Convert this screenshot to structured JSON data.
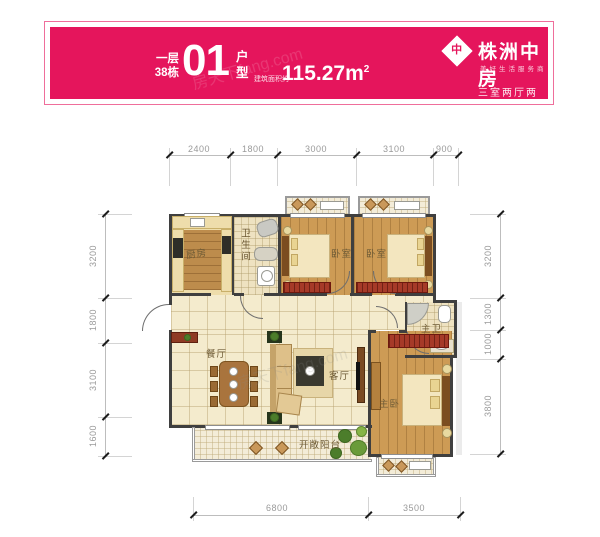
{
  "header": {
    "floor": "一层",
    "building": "38栋",
    "unit": "01",
    "unit_top": "户",
    "unit_bottom": "型",
    "area_prefix": "建筑面积约",
    "area_value": "115.27m",
    "area_exp": "2",
    "logo_glyph": "中",
    "brand": "株洲中房",
    "tagline": "美好生活服务商",
    "summary": "三室两厅两卫",
    "banner_color": "#e5155c"
  },
  "watermark": "房天下fang.com",
  "rooms": {
    "kitchen": "厨房",
    "bathroom": "卫生间",
    "bedroom1": "卧室",
    "bedroom2": "卧室",
    "master_bath": "主卫",
    "master_bedroom": "主卧",
    "dining": "餐厅",
    "living": "客厅",
    "balcony": "开敞阳台"
  },
  "dims": {
    "top": [
      "2400",
      "1800",
      "3000",
      "3100",
      "900"
    ],
    "left": [
      "3200",
      "1800",
      "3100",
      "1600"
    ],
    "right": [
      "3200",
      "1300",
      "1000",
      "3800"
    ],
    "bottom": [
      "6800",
      "3500"
    ]
  }
}
